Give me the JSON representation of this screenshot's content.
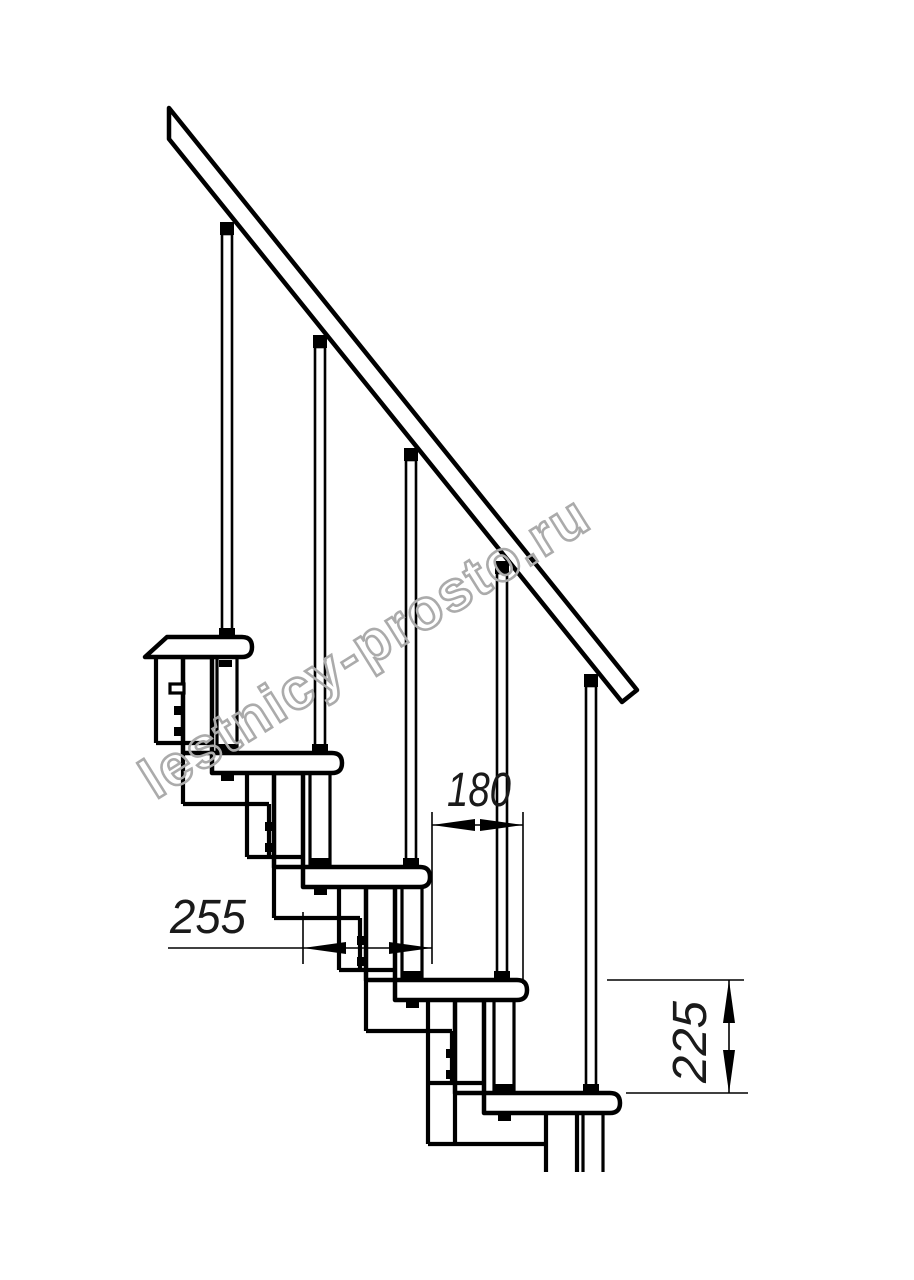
{
  "drawing": {
    "title": "modular staircase side-view drawing",
    "watermark": "lestnicy-prosto.ru",
    "dimensions": {
      "tread_depth": "255",
      "run": "180",
      "rise": "225"
    },
    "colors": {
      "line": "#000000",
      "background": "#ffffff",
      "watermark": "#ababab"
    },
    "counts": {
      "steps": 5,
      "balusters": 5
    }
  }
}
